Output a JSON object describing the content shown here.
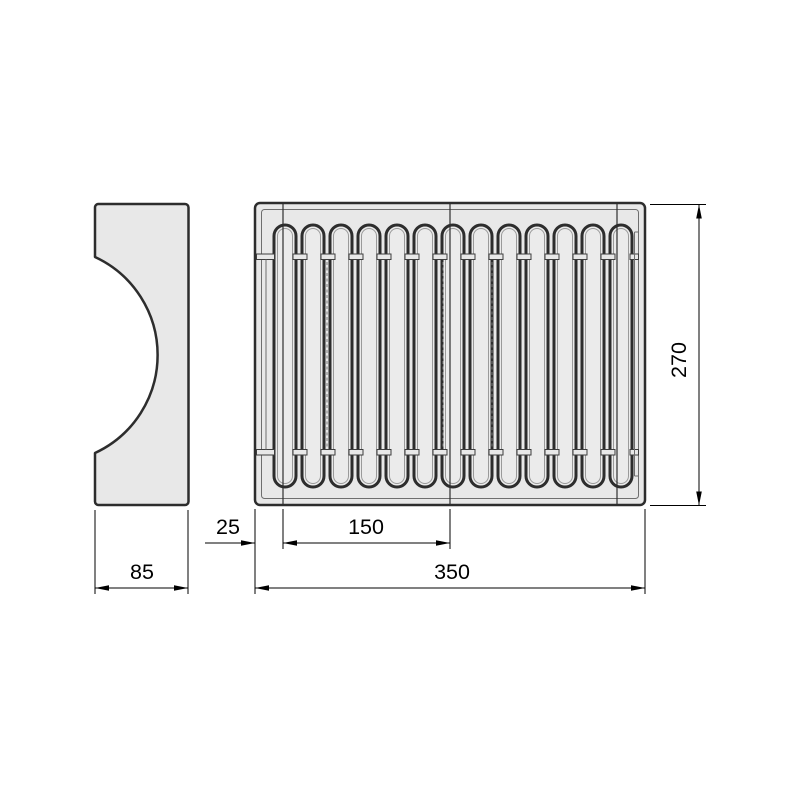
{
  "colors": {
    "background": "#ffffff",
    "body_fill": "#e8e8e8",
    "slot_fill": "#ebebeb",
    "outline": "#2d2d2d",
    "thin_line": "#6e6e6e"
  },
  "dimensions": {
    "left_margin": "25",
    "module_width": "150",
    "overall_width": "350",
    "overall_depth": "270",
    "side_view_width": "85"
  },
  "top_view": {
    "slot_count": 13,
    "slot_pitch": 28,
    "first_slot_center_x": 285,
    "slot_top_y": 225,
    "slot_height": 262,
    "seam_xs": [
      283,
      450,
      617
    ],
    "dashed_line_xs": [
      327,
      443,
      492
    ]
  }
}
